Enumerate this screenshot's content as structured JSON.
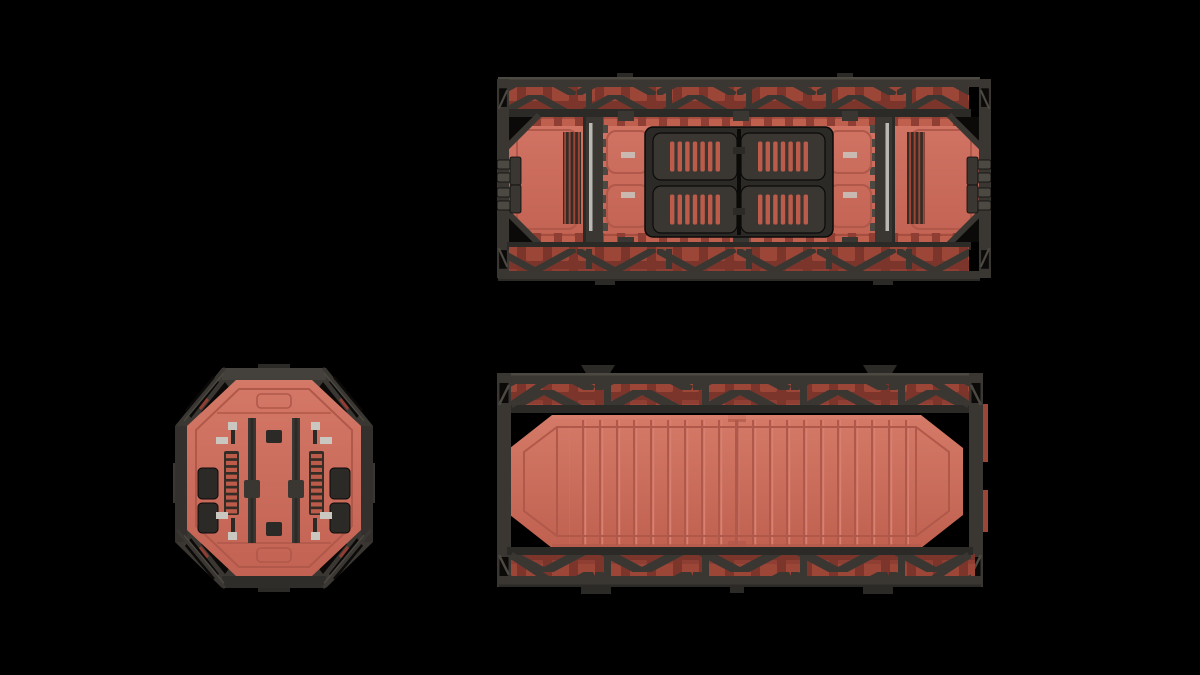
{
  "canvas": {
    "width": 1200,
    "height": 675
  },
  "palette": {
    "bg": "#000000",
    "hull": "#cb6a5a",
    "hullLight": "#d98070",
    "hullShade": "#b0584a",
    "hullDeep": "#8e3e32",
    "hullDeeper": "#7c352b",
    "ventRed": "#bd5b4a",
    "tabRed": "#9c4638",
    "crenRed": "#bf5f4d",
    "frame": "#3a3733",
    "frameLight": "#4c4842",
    "frameDark": "#2c2a27",
    "blackDetail": "#0b0a09",
    "metal": "#c9c7c0",
    "grilleDark": "#352c26"
  },
  "views": [
    {
      "id": "top-view",
      "name": "cargo-container-top-view",
      "x": 497,
      "y": 73,
      "width": 494,
      "height": 212
    },
    {
      "id": "end-view",
      "name": "cargo-container-end-view",
      "x": 173,
      "y": 364,
      "width": 202,
      "height": 228
    },
    {
      "id": "side-view",
      "name": "cargo-container-side-view",
      "x": 497,
      "y": 364,
      "width": 492,
      "height": 230
    }
  ],
  "details": {
    "vent_slots_per_hatch_panel": 7,
    "hatch_panels": 4,
    "side_panel_ribs": 20,
    "ladder_rungs": 9,
    "clamps_per_side": 2
  }
}
